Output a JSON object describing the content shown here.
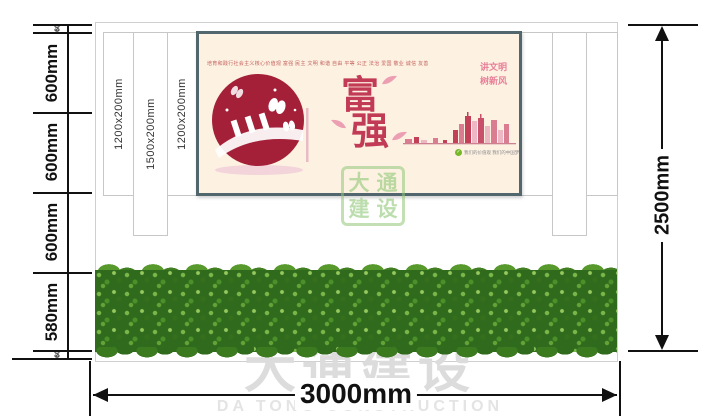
{
  "dims": {
    "left_chain": [
      "60",
      "600mm",
      "600mm",
      "600mm",
      "580mm",
      "60"
    ],
    "right_label": "2500mm",
    "bottom_label": "3000mm",
    "panel_labels": [
      "1200x200mm",
      "1500x200mm",
      "1200x200mm"
    ]
  },
  "poster": {
    "header_text": "培育和践行社会主义核心价值观  富强 民主 文明 和谐 自由 平等 公正 法治 爱国 敬业 诚信 友善",
    "char_top": "富",
    "char_bottom": "强",
    "slogan_line1": "讲文明",
    "slogan_line2": "树新风",
    "caption_icon": "✓",
    "caption": "我们的价值观 我们的中国梦",
    "colors": {
      "background": "#fdf2e2",
      "frame": "#51666d",
      "accent_red": "#c13a56",
      "slogan_pink": "#e87f98",
      "caption_green": "#76b82a"
    }
  },
  "watermark": {
    "logo_chars": [
      "大",
      "通",
      "建",
      "设"
    ],
    "bottom_cn": "大通建设",
    "bottom_en": "DA TONG CONSTRUCTION",
    "gray": "#dcdcdc",
    "green": "#90c776"
  },
  "hedge": {
    "color": "#2f6a1d"
  }
}
